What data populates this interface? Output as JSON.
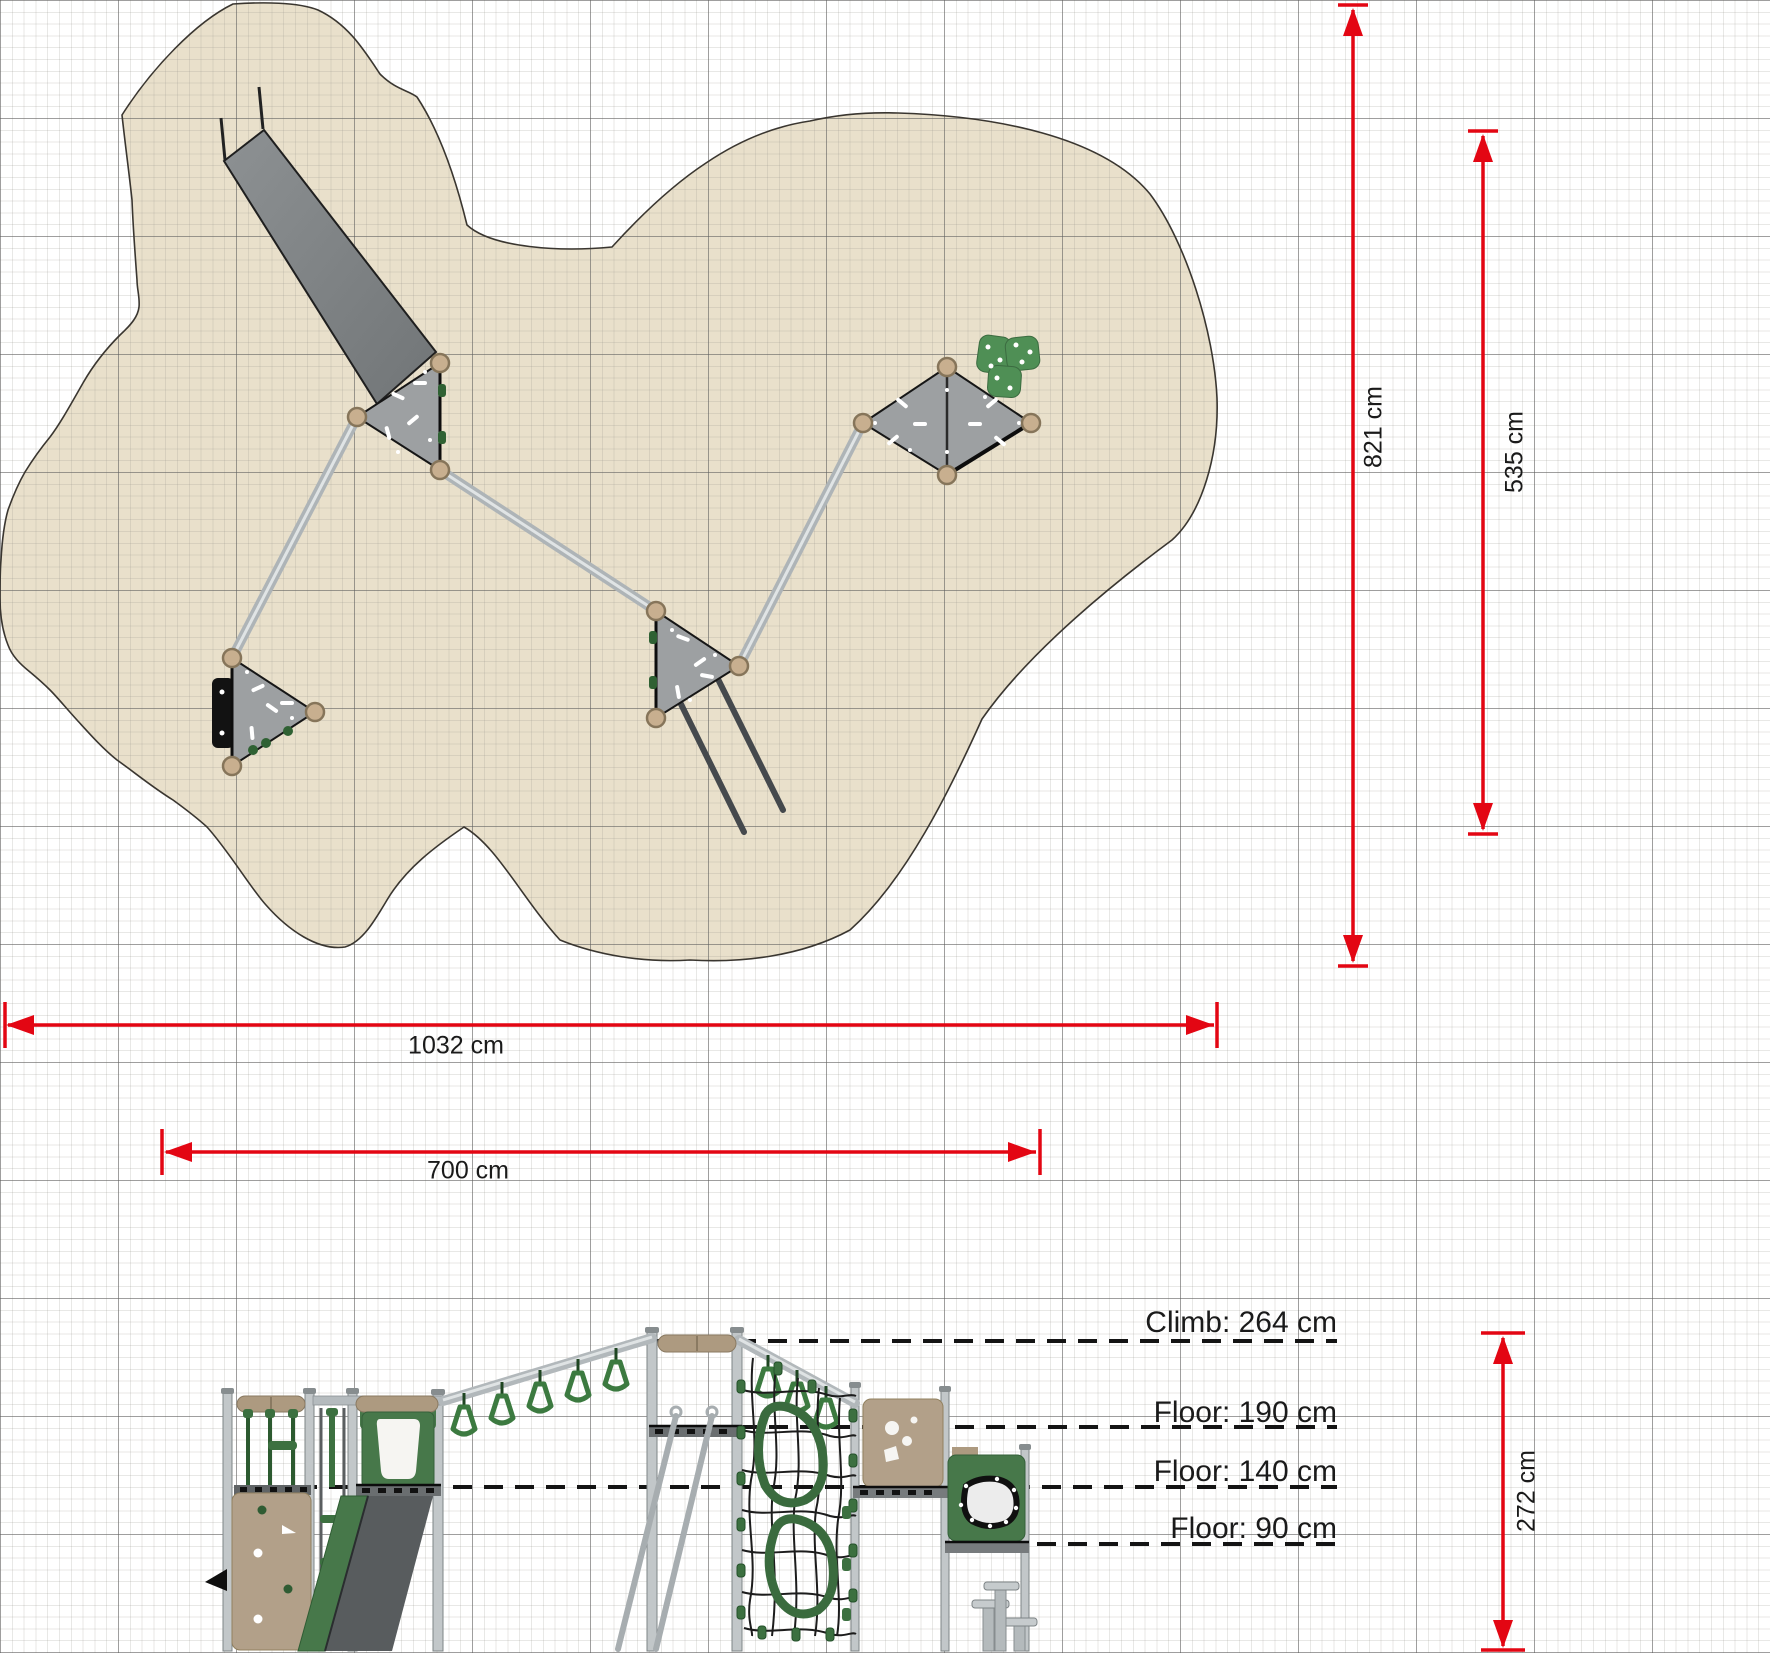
{
  "dimensions": {
    "total_width": "1032 cm",
    "play_width": "700 cm",
    "total_depth": "821 cm",
    "play_depth": "535 cm",
    "structure_height": "272 cm"
  },
  "height_markers": [
    "Climb: 264 cm",
    "Floor: 190 cm",
    "Floor: 140 cm",
    "Floor: 90 cm"
  ],
  "colors": {
    "dimension_red": "#e30613",
    "surface_beige": "#e9e0cb",
    "equipment_green": "#3c7040",
    "panel_tan": "#b2a089",
    "platform_gray": "#9da0a2",
    "marker_black": "#141414"
  }
}
